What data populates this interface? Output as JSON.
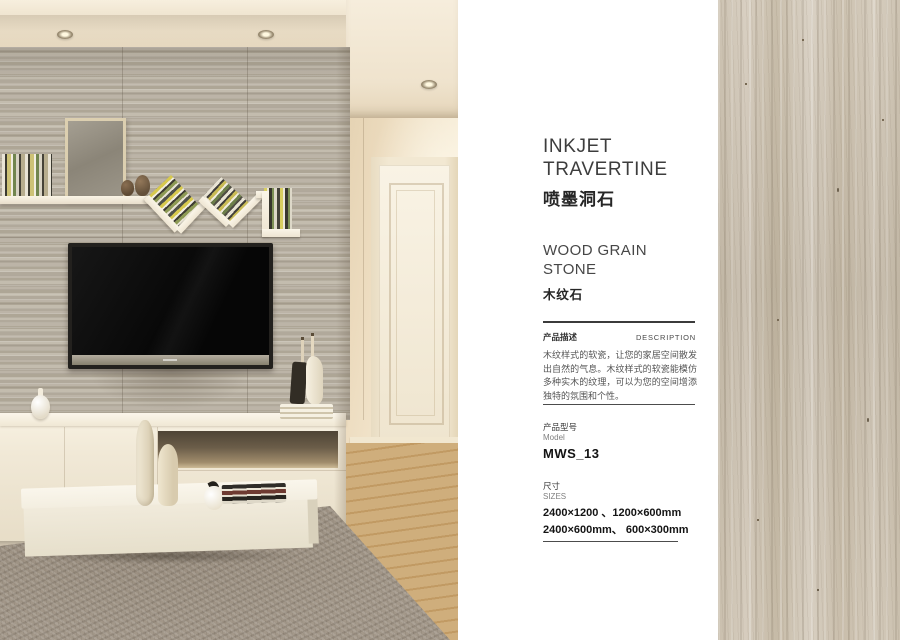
{
  "panel": {
    "title": {
      "en1": "INKJET",
      "en2": "TRAVERTINE",
      "cn": "喷墨洞石"
    },
    "category": {
      "en1": "WOOD GRAIN",
      "en2": "STONE",
      "cn": "木纹石"
    },
    "description": {
      "label_cn": "产品描述",
      "label_en": "DESCRIPTION",
      "body": "木纹样式的软瓷，让您的家居空间散发出自然的气息。木纹样式的软瓷能模仿多种实木的纹理，可以为您的空间增添独特的氛围和个性。"
    },
    "model": {
      "label_cn": "产品型号",
      "label_en": "Model",
      "value": "MWS_13"
    },
    "sizes": {
      "label_cn": "尺寸",
      "label_en": "SIZES",
      "line1": "2400×1200 、1200×600mm",
      "line2": "2400×600mm、 600×300mm"
    }
  },
  "colors": {
    "panel_background": "#ffffff",
    "heading_text": "#3d3d3d",
    "body_text": "#555555",
    "rule": "#3b3b3b",
    "stone_swatch_base": "#cbc1af",
    "travertine_wall_base": "#b7afa2"
  }
}
